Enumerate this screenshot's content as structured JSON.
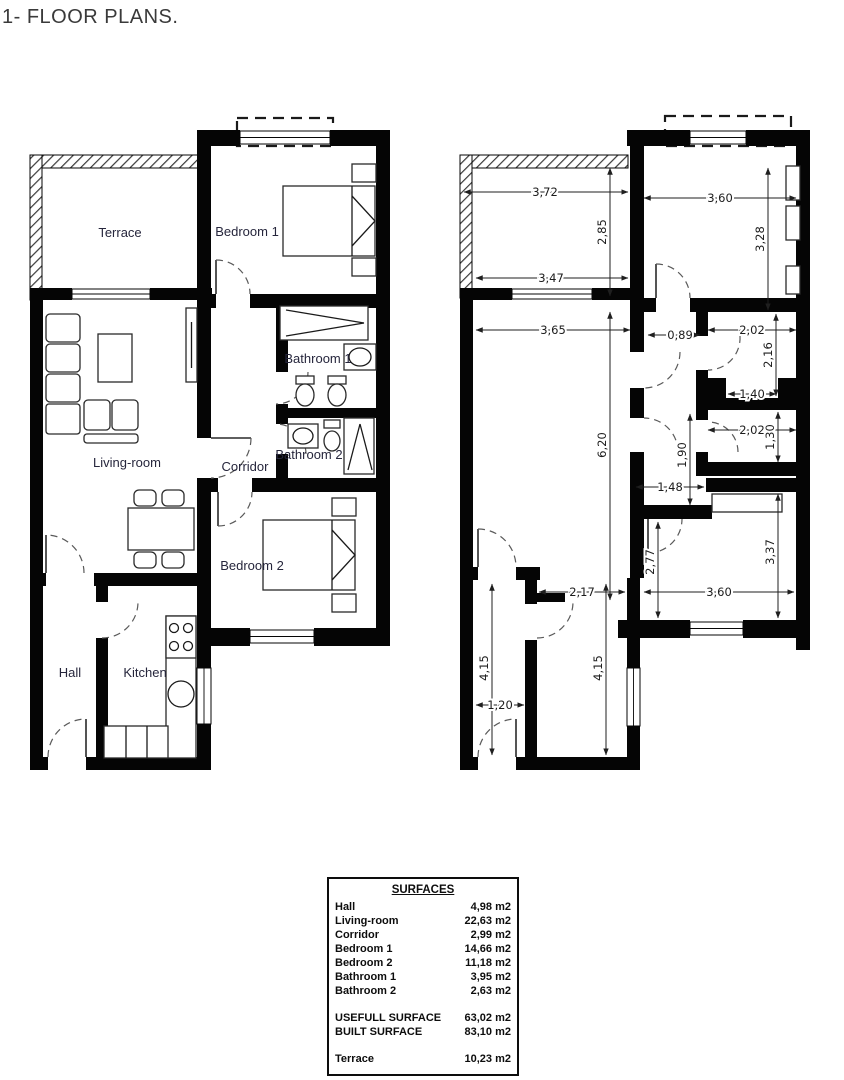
{
  "page_title": "1- FLOOR PLANS.",
  "plan_left": {
    "description": "Furnished floor plan",
    "room_labels": {
      "terrace": "Terrace",
      "bedroom1": "Bedroom 1",
      "living": "Living-room",
      "corridor": "Corridor",
      "bathroom1": "Bathroom 1",
      "bathroom2": "Bathroom 2",
      "bedroom2": "Bedroom 2",
      "hall": "Hall",
      "kitchen": "Kitchen"
    }
  },
  "plan_right": {
    "description": "Dimensioned floor plan (metres)",
    "dims": {
      "terrace_top_width": "3,72",
      "terrace_depth": "2,85",
      "terrace_bottom_width": "3,47",
      "bedroom1_width": "3,60",
      "bedroom1_depth": "3,28",
      "living_width": "3,65",
      "corridor_top_width": "0,89",
      "bathroom1_width": "2,02",
      "bathroom1_depth": "2,16",
      "closet_niche_width": "1,40",
      "bathroom2_width": "2,02",
      "bathroom2_depth": "1,30",
      "living_length": "6,20",
      "corridor_length": "1,90",
      "corridor_bottom_width": "1,48",
      "bedroom2_left_depth": "2,77",
      "bedroom2_depth": "3,37",
      "kitchen_width": "2,17",
      "bedroom2_width": "3,60",
      "hall_length": "4,15",
      "kitchen_length": "4,15",
      "hall_width": "1,20"
    }
  },
  "surfaces": {
    "title": "SURFACES",
    "rows": [
      {
        "label": "Hall",
        "value": "4,98 m2"
      },
      {
        "label": "Living-room",
        "value": "22,63 m2"
      },
      {
        "label": "Corridor",
        "value": "2,99 m2"
      },
      {
        "label": "Bedroom 1",
        "value": "14,66 m2"
      },
      {
        "label": "Bedroom 2",
        "value": "11,18 m2"
      },
      {
        "label": "Bathroom 1",
        "value": "3,95 m2"
      },
      {
        "label": "Bathroom 2",
        "value": "2,63 m2"
      }
    ],
    "totals": [
      {
        "label": "USEFULL SURFACE",
        "value": "63,02 m2"
      },
      {
        "label": "BUILT SURFACE",
        "value": "83,10 m2"
      }
    ],
    "extra": [
      {
        "label": "Terrace",
        "value": "10,23 m2"
      }
    ]
  }
}
